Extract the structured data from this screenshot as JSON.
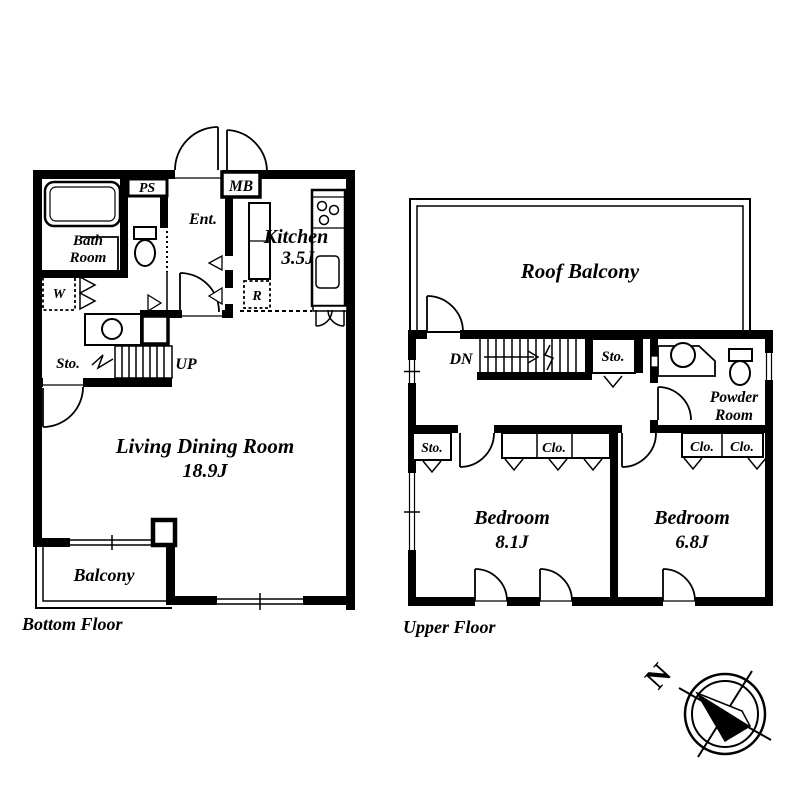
{
  "document": {
    "type": "apartment-floor-plan",
    "colors": {
      "line": "#000000",
      "background": "#ffffff"
    }
  },
  "bottom_floor": {
    "title": "Bottom Floor",
    "labels": {
      "bath_line1": "Bath",
      "bath_line2": "Room",
      "ps": "PS",
      "ent": "Ent.",
      "mb": "MB",
      "kitchen_name": "Kitchen",
      "kitchen_size": "3.5J",
      "washer": "W",
      "fridge": "R",
      "storage": "Sto.",
      "stairs_up": "UP",
      "living_name": "Living Dining Room",
      "living_size": "18.9J",
      "balcony": "Balcony"
    }
  },
  "upper_floor": {
    "title": "Upper Floor",
    "labels": {
      "roof_balcony": "Roof Balcony",
      "stairs_down": "DN",
      "storage_hall": "Sto.",
      "powder_line1": "Powder",
      "powder_line2": "Room",
      "storage_bedroom": "Sto.",
      "closet_bedroom1": "Clo.",
      "closet_bedroom2_left": "Clo.",
      "closet_bedroom2_right": "Clo.",
      "bedroom1_name": "Bedroom",
      "bedroom1_size": "8.1J",
      "bedroom2_name": "Bedroom",
      "bedroom2_size": "6.8J"
    }
  },
  "compass": {
    "north": "N"
  }
}
